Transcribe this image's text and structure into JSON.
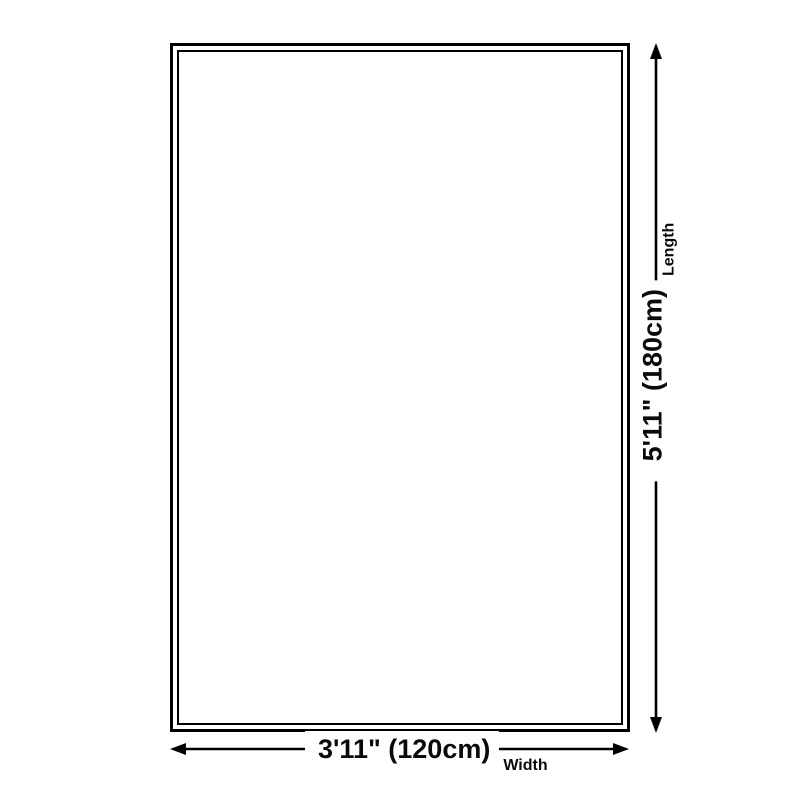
{
  "diagram": {
    "type": "product-size-diagram",
    "shape": "rectangle",
    "colors": {
      "background": "#ffffff",
      "line": "#000000",
      "text": "#0a0a0a"
    },
    "width_dimension": {
      "value": "3'11\" (120cm)",
      "label": "Width"
    },
    "length_dimension": {
      "value": "5'11\" (180cm)",
      "label": "Length"
    },
    "icons": {
      "up_arrow": "up-arrow-icon",
      "down_arrow": "down-arrow-icon",
      "left_arrow": "left-arrow-icon",
      "right_arrow": "right-arrow-icon"
    }
  }
}
